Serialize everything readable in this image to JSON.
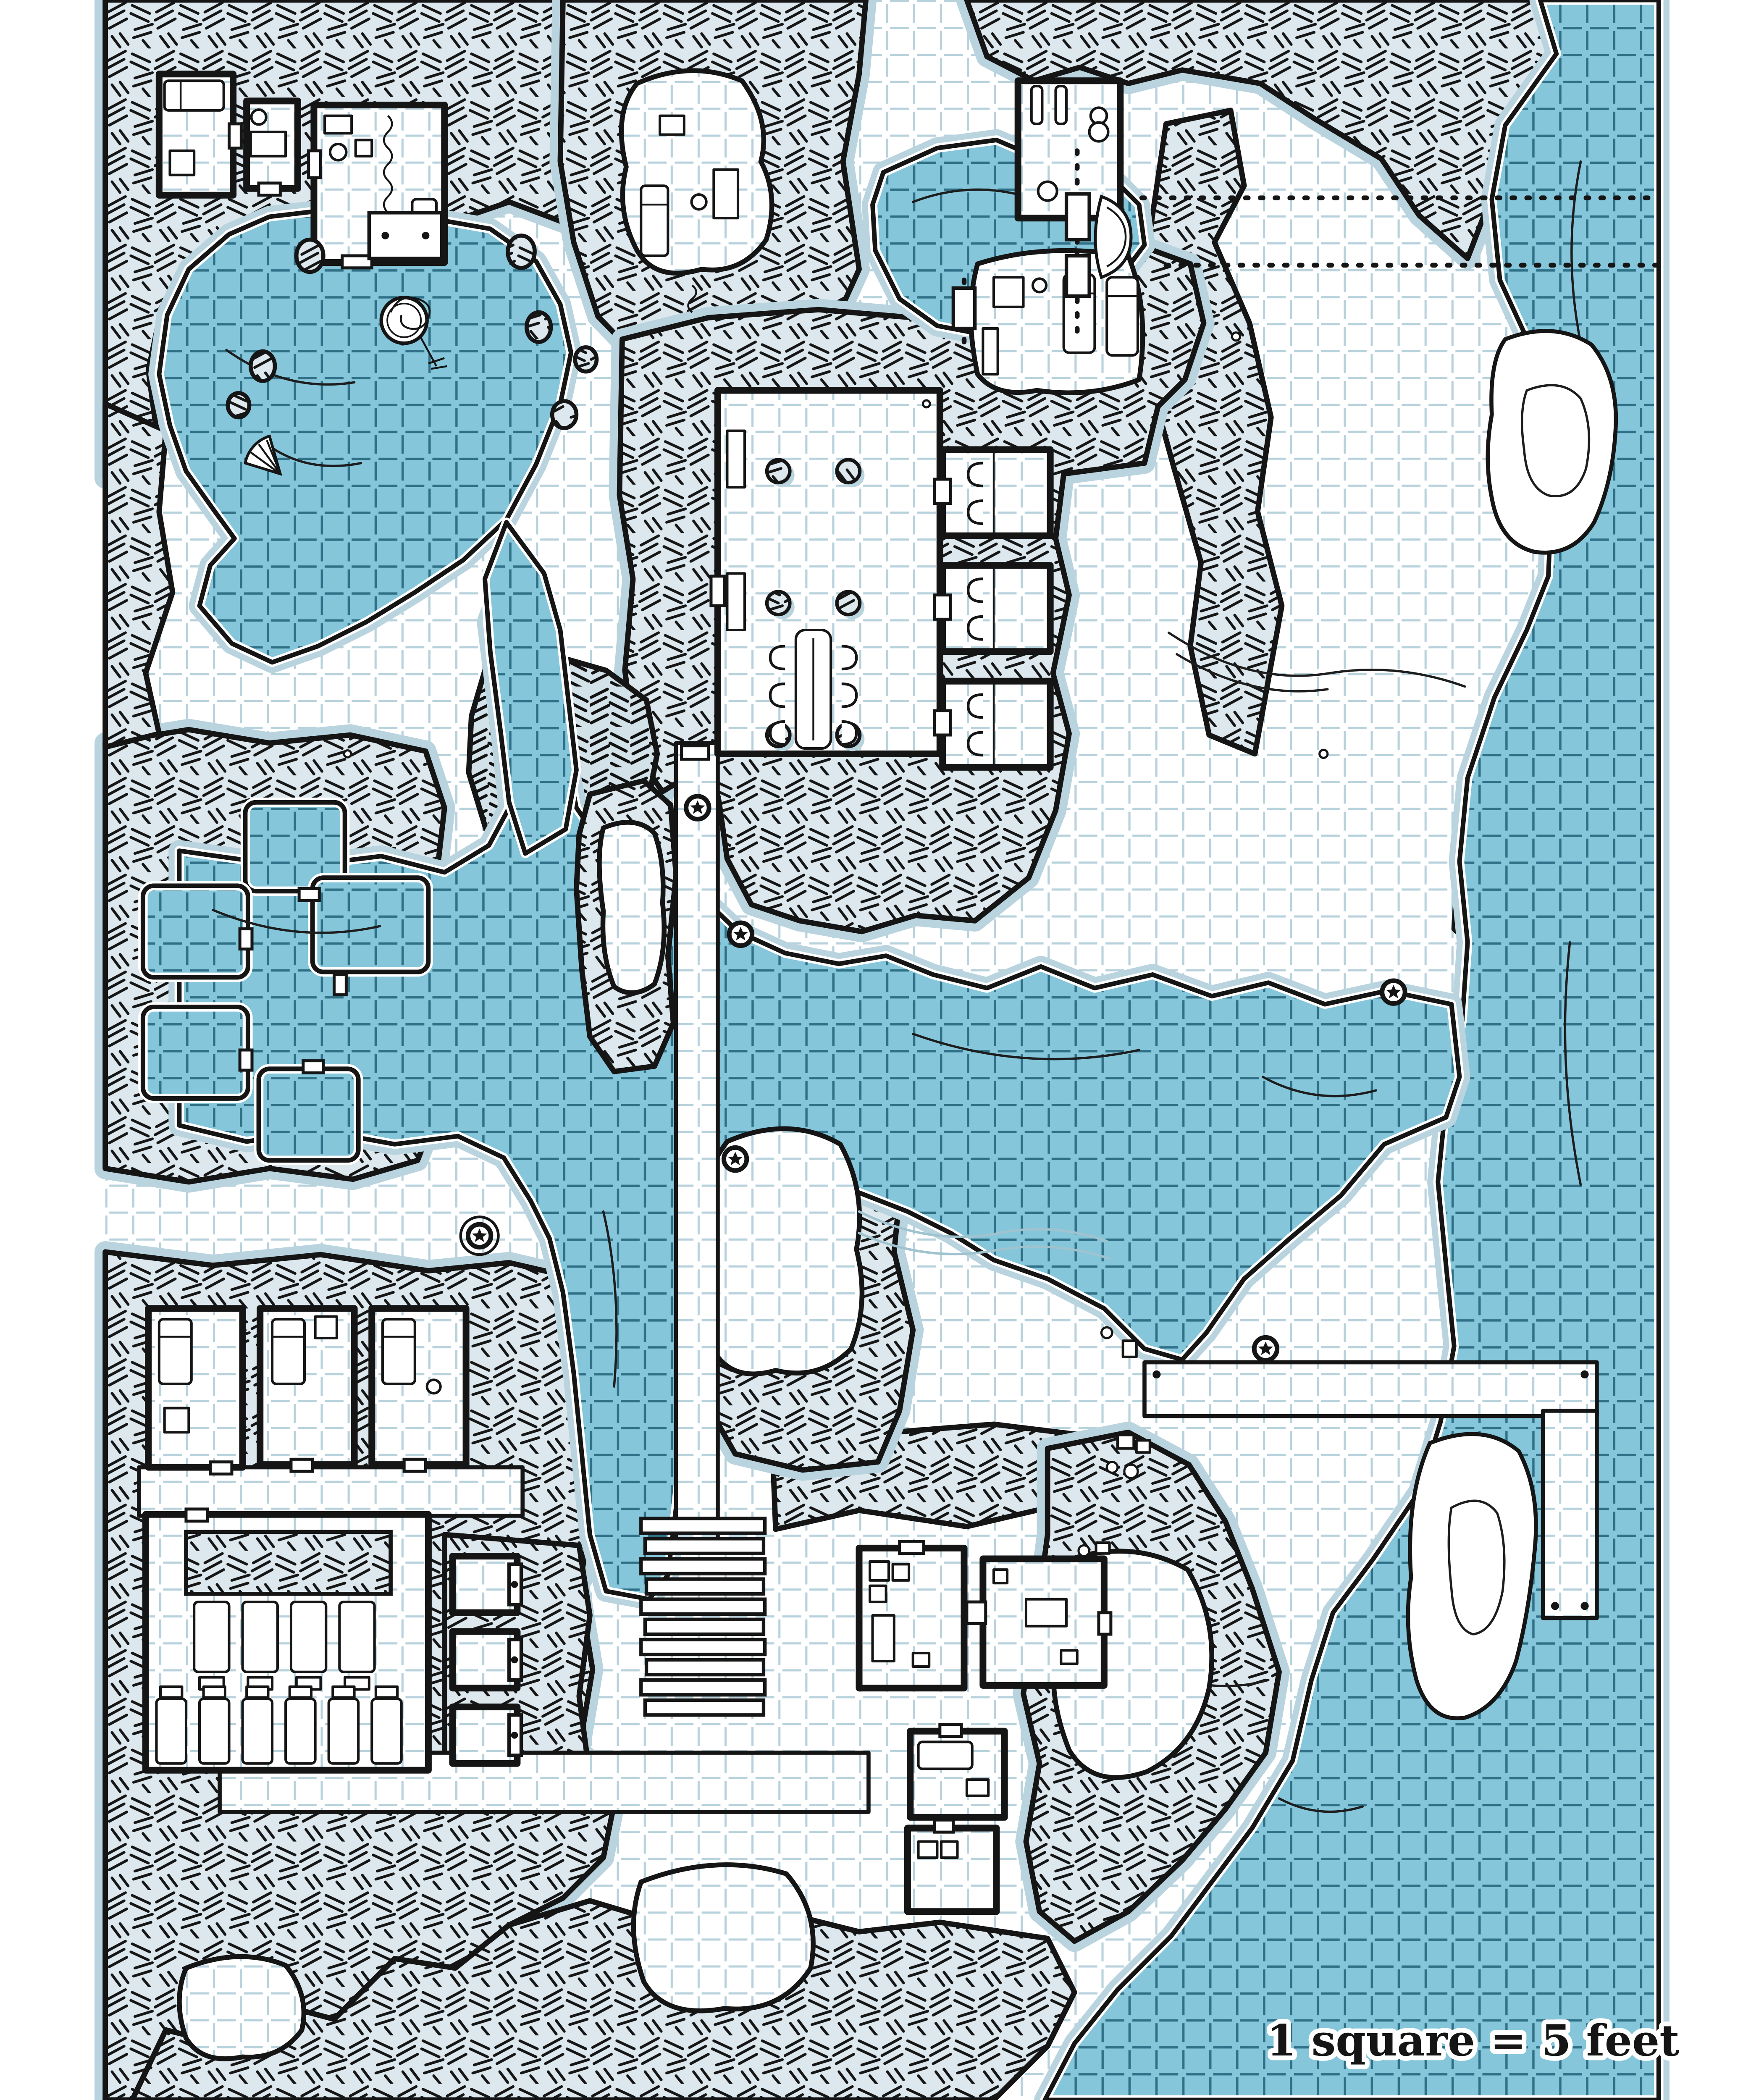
{
  "map": {
    "scale_label": "1 square = 5 feet",
    "grid": {
      "unit": "square",
      "feet_per_square": 5,
      "style": "dashed square grid"
    },
    "colors": {
      "water": "#85c6db",
      "water_grid": "#2f7087",
      "floor": "#ffffff",
      "floor_grid": "#b7d2dc",
      "rock_fill": "#dce8ee",
      "ink": "#151515",
      "soft_shadow": "#b9d4de"
    },
    "markers": {
      "star_waypoints": 6
    },
    "features": [
      "top-left-lake",
      "serpent-statue-island",
      "shell",
      "wooden-bridge",
      "top-right-pond",
      "plank-bridges",
      "rowboat",
      "dotted-paths",
      "right-river",
      "river-island",
      "shore-pit",
      "central-channel",
      "stone-causeway",
      "flooded-cell-pools",
      "great-hall",
      "hall-pillars",
      "long-table",
      "chairs",
      "side-cells-with-beds",
      "guard-room",
      "top-left-quarters",
      "hermit-cave",
      "treasure-room",
      "barracks",
      "bunk-beds",
      "prison-cells",
      "wide-stairs",
      "storage-rooms",
      "crates",
      "dock-pier",
      "bottom-caves"
    ]
  }
}
